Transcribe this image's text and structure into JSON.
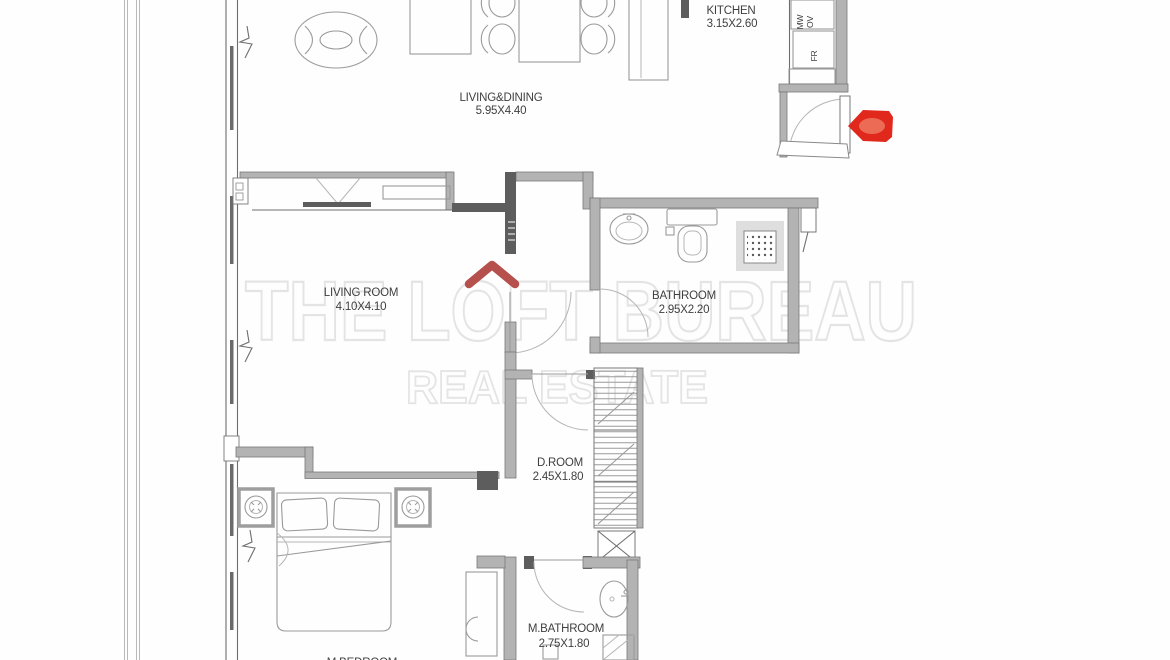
{
  "watermark": {
    "line1": "THE LOFT BUREAU",
    "line2": "REAL ESTATE"
  },
  "rooms": {
    "kitchen": {
      "name": "KITCHEN",
      "dims": "3.15X2.60"
    },
    "living_dining": {
      "name": "LIVING&DINING",
      "dims": "5.95X4.40"
    },
    "living_room": {
      "name": "LIVING ROOM",
      "dims": "4.10X4.10"
    },
    "bathroom": {
      "name": "BATHROOM",
      "dims": "2.95X2.20"
    },
    "d_room": {
      "name": "D.ROOM",
      "dims": "2.45X1.80"
    },
    "m_bathroom": {
      "name": "M.BATHROOM",
      "dims": "2.75X1.80"
    },
    "m_bedroom": {
      "name": "M.BEDROOM",
      "dims": ""
    }
  },
  "appliances": {
    "mw": "MW",
    "ov": "OV",
    "fr": "FR"
  },
  "colors": {
    "marker_red": "#e0281c",
    "logo_red": "#b5504d",
    "watermark_gray": "#e4e4e4",
    "wall_gray": "#6e6e6e",
    "text_gray": "#3f3f3f"
  }
}
